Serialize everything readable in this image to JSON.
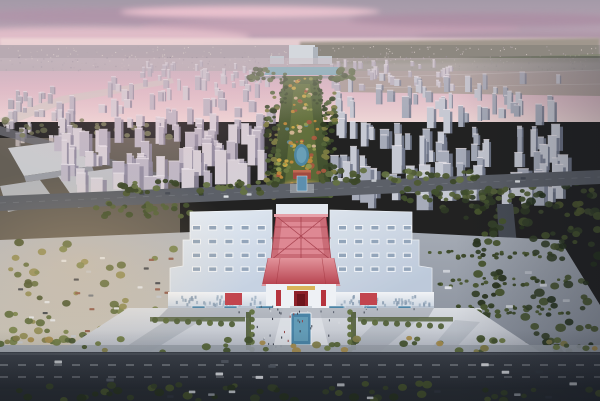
{
  "scene": {
    "description": "Dusk aerial rendering: symmetric exhibition hall with red steel gate tower, long landscaped park axis flanked by high-rise residential blocks, front plaza with reflecting pool, parking lots and city roads under a pink-violet sky"
  },
  "palette": {
    "sky_top": "#a49aa8",
    "sky_mid": "#c2a6b8",
    "sky_pink": "#e2b9c6",
    "sky_horizon": "#eed6d6",
    "haze_city": "#b7aab1",
    "park_mid": "#5a6a3c",
    "park_dark": "#3a482a",
    "lawn": "#71803f",
    "lake": "#79aebb",
    "pond": "#4e86a0",
    "pond_inner": "#6fa3bb",
    "roof_light": "#e9eff6",
    "roof_shadow": "#c6d2e2",
    "facade_light": "#f1f3f6",
    "facade_shadow": "#c9d3df",
    "hip_light": "#e2939b",
    "hip_dark": "#b53f4c",
    "lattice": "#d4717c",
    "lattice_line": "#a13a46",
    "red_accent": "#c2454e",
    "door_red": "#8e2129",
    "gold": "#d8b35a",
    "plaza_light": "#d9dce1",
    "plaza_dark": "#b6bbc5",
    "pool": "#4a84a6",
    "pool_inner": "#67a0ba",
    "kiosk": "#4f86a8",
    "road_light": "#3e434c",
    "road_dark": "#2a2f36",
    "back_road": "#5c6068",
    "hedge": "#4a5730",
    "end_tower": "#d4d8dd"
  },
  "kiosks": {
    "xs": [
      192,
      224,
      256,
      332,
      364,
      398
    ],
    "y": 306,
    "w": 13,
    "h": 6
  },
  "generators": [
    {
      "type": "specks",
      "target": "g-horizon-specks",
      "seed": 101,
      "count": 260,
      "region": [
        0,
        46,
        600,
        22
      ],
      "size": 1.1,
      "hr": 1,
      "colors": [
        "#d9cdc9",
        "#c7b9bb",
        "#b5a8ae",
        "#e3d6d0"
      ],
      "opacity": 0.7
    },
    {
      "type": "specks",
      "target": "g-horizon-specks",
      "seed": 102,
      "count": 150,
      "region": [
        0,
        56,
        600,
        14
      ],
      "size": 1.3,
      "hr": 1,
      "colors": [
        "#9e94a0",
        "#8d8492",
        "#ab9fa8"
      ],
      "opacity": 0.6
    },
    {
      "type": "towers",
      "target": "g-far-city",
      "seed": 103,
      "count": 40,
      "region": [
        140,
        66,
        130,
        26
      ],
      "w": [
        2.5,
        5
      ],
      "h": [
        5,
        12
      ],
      "scale": [
        0.7,
        1
      ],
      "faces": [
        "#cfc8d1",
        "#bab3c0",
        "#a29aab"
      ]
    },
    {
      "type": "towers",
      "target": "g-far-city",
      "seed": 104,
      "count": 38,
      "region": [
        330,
        66,
        120,
        26
      ],
      "w": [
        2.5,
        5
      ],
      "h": [
        5,
        12
      ],
      "scale": [
        0.7,
        1
      ],
      "faces": [
        "#cfc8d1",
        "#bab3c0",
        "#a29aab"
      ]
    },
    {
      "type": "towers",
      "target": "g-far-city",
      "seed": 105,
      "count": 26,
      "region": [
        0,
        92,
        62,
        55
      ],
      "w": [
        3,
        6
      ],
      "h": [
        6,
        14
      ],
      "scale": [
        0.7,
        1
      ],
      "faces": [
        "#c9c2c9",
        "#b3adb8",
        "#968fa0"
      ]
    },
    {
      "type": "blobs",
      "target": "g-left-district",
      "seed": 106,
      "count": 30,
      "region": [
        0,
        120,
        180,
        18
      ],
      "r": [
        2,
        4
      ],
      "colors": [
        "#6d6f52",
        "#7d7f5c",
        "#5d6146"
      ],
      "opacity": 0.85
    },
    {
      "type": "towers",
      "target": "g-city-left",
      "seed": 107,
      "count": 120,
      "region": [
        52,
        90,
        215,
        110
      ],
      "w": [
        4,
        9
      ],
      "h": [
        9,
        26
      ],
      "scale": [
        0.55,
        1.45
      ],
      "faces": [
        "#d6cfd6",
        "#beb7c4",
        "#8f8a9d"
      ]
    },
    {
      "type": "towers",
      "target": "g-city-right",
      "seed": 108,
      "count": 135,
      "region": [
        330,
        80,
        228,
        132
      ],
      "w": [
        4,
        9
      ],
      "h": [
        9,
        26
      ],
      "scale": [
        0.55,
        1.5
      ],
      "faces": [
        "#c6c9d3",
        "#a6abb9",
        "#737a8d"
      ]
    },
    {
      "type": "blobs",
      "target": "g-city-right",
      "seed": 109,
      "count": 55,
      "region": [
        430,
        182,
        170,
        36
      ],
      "r": [
        2.5,
        5
      ],
      "colors": [
        "#3f4a30",
        "#2f3a26",
        "#4c572f"
      ],
      "opacity": 0.9
    },
    {
      "type": "blobs",
      "target": "g-park-belts",
      "seed": 110,
      "count": 60,
      "region": [
        266,
        92,
        13,
        106
      ],
      "r": [
        1.6,
        3.4
      ],
      "colors": [
        "#3c4a2b",
        "#2f3b22",
        "#55663a",
        "#7c7c42"
      ],
      "opacity": 0.95
    },
    {
      "type": "blobs",
      "target": "g-park-belts",
      "seed": 111,
      "count": 60,
      "region": [
        323,
        92,
        13,
        106
      ],
      "r": [
        1.6,
        3.4
      ],
      "colors": [
        "#3c4a2b",
        "#2f3b22",
        "#55663a",
        "#7c7c42"
      ],
      "opacity": 0.95
    },
    {
      "type": "blobs",
      "target": "g-park-belts",
      "seed": 112,
      "count": 26,
      "region": [
        280,
        74,
        8,
        30
      ],
      "r": [
        1.2,
        2.4
      ],
      "colors": [
        "#3f4c2d",
        "#54663c"
      ],
      "opacity": 0.9
    },
    {
      "type": "blobs",
      "target": "g-park-belts",
      "seed": 113,
      "count": 26,
      "region": [
        314,
        74,
        8,
        30
      ],
      "r": [
        1.2,
        2.4
      ],
      "colors": [
        "#3f4c2d",
        "#54663c"
      ],
      "opacity": 0.9
    },
    {
      "type": "blobs",
      "target": "g-park-belts",
      "seed": 114,
      "count": 20,
      "region": [
        248,
        68,
        26,
        12
      ],
      "r": [
        2,
        4
      ],
      "colors": [
        "#465233",
        "#5a6a3e"
      ],
      "opacity": 0.9
    },
    {
      "type": "blobs",
      "target": "g-park-belts",
      "seed": 115,
      "count": 20,
      "region": [
        330,
        68,
        26,
        12
      ],
      "r": [
        2,
        4
      ],
      "colors": [
        "#465233",
        "#5a6a3e"
      ],
      "opacity": 0.9
    },
    {
      "type": "blobs",
      "target": "g-park-accents",
      "seed": 116,
      "count": 26,
      "region": [
        290,
        78,
        22,
        36
      ],
      "r": [
        1,
        2.4
      ],
      "colors": [
        "#c08a3c",
        "#ccaa48",
        "#a85a40",
        "#8f9a50",
        "#d3b693"
      ],
      "opacity": 0.95
    },
    {
      "type": "blobs",
      "target": "g-park-accents",
      "seed": 117,
      "count": 34,
      "region": [
        284,
        114,
        34,
        44
      ],
      "r": [
        1.2,
        2.8
      ],
      "colors": [
        "#c08a3c",
        "#ccaa48",
        "#a85a40",
        "#8f9a50",
        "#d3b693",
        "#5a8a96"
      ],
      "opacity": 0.95
    },
    {
      "type": "blobs",
      "target": "g-park-accents",
      "seed": 118,
      "count": 34,
      "region": [
        278,
        160,
        46,
        34
      ],
      "r": [
        1.4,
        3.2
      ],
      "colors": [
        "#c08a3c",
        "#ccaa48",
        "#a85a40",
        "#8f9a50",
        "#6b7a42"
      ],
      "opacity": 0.95
    },
    {
      "type": "cars",
      "target": "g-back-road",
      "seed": 119,
      "count": 5,
      "region": [
        80,
        191,
        170,
        6
      ],
      "w": 5,
      "h": 2.4,
      "colors": [
        "#e4e7ea",
        "#454a54",
        "#c6cad0"
      ]
    },
    {
      "type": "cars",
      "target": "g-back-road",
      "seed": 120,
      "count": 5,
      "region": [
        360,
        177,
        170,
        6
      ],
      "w": 5,
      "h": 2.4,
      "colors": [
        "#e4e7ea",
        "#454a54",
        "#c6cad0"
      ]
    },
    {
      "type": "blobs",
      "target": "g-back-road",
      "seed": 121,
      "count": 40,
      "region": [
        120,
        181,
        165,
        13
      ],
      "r": [
        2.2,
        4.2
      ],
      "colors": [
        "#4e5a33",
        "#3c4829",
        "#647243"
      ],
      "opacity": 0.95
    },
    {
      "type": "blobs",
      "target": "g-back-road",
      "seed": 122,
      "count": 40,
      "region": [
        318,
        170,
        160,
        13
      ],
      "r": [
        2.2,
        4.2
      ],
      "colors": [
        "#4e5a33",
        "#3c4829",
        "#647243"
      ],
      "opacity": 0.95
    },
    {
      "type": "blobs",
      "target": "g-back-road",
      "seed": 123,
      "count": 28,
      "region": [
        88,
        203,
        110,
        14
      ],
      "r": [
        2.2,
        4
      ],
      "colors": [
        "#55623a",
        "#41502d"
      ],
      "opacity": 0.95
    },
    {
      "type": "blobs",
      "target": "g-back-road",
      "seed": 124,
      "count": 30,
      "region": [
        400,
        188,
        130,
        14
      ],
      "r": [
        2.2,
        4
      ],
      "colors": [
        "#55623a",
        "#41502d"
      ],
      "opacity": 0.95
    },
    {
      "type": "blobs",
      "target": "g-right-trees",
      "seed": 125,
      "count": 70,
      "region": [
        475,
        205,
        28,
        190
      ],
      "r": [
        2.5,
        5
      ],
      "colors": [
        "#36422a",
        "#2a3520",
        "#48552e"
      ],
      "opacity": 0.95
    },
    {
      "type": "blobs",
      "target": "g-right-trees",
      "seed": 126,
      "count": 80,
      "region": [
        520,
        195,
        80,
        200
      ],
      "r": [
        2.5,
        5.5
      ],
      "colors": [
        "#333f28",
        "#27331f",
        "#45522d"
      ],
      "opacity": 0.9
    },
    {
      "type": "blobs",
      "target": "g-right-hedges",
      "seed": 127,
      "count": 24,
      "region": [
        428,
        250,
        125,
        8
      ],
      "r": [
        1.6,
        2.6
      ],
      "colors": [
        "#49562f",
        "#3a4727"
      ],
      "opacity": 0.95
    },
    {
      "type": "blobs",
      "target": "g-right-hedges",
      "seed": 128,
      "count": 24,
      "region": [
        438,
        278,
        130,
        8
      ],
      "r": [
        1.6,
        2.6
      ],
      "colors": [
        "#49562f",
        "#3a4727"
      ],
      "opacity": 0.95
    },
    {
      "type": "blobs",
      "target": "g-right-hedges",
      "seed": 129,
      "count": 24,
      "region": [
        448,
        306,
        135,
        8
      ],
      "r": [
        1.6,
        2.6
      ],
      "colors": [
        "#49562f",
        "#3a4727"
      ],
      "opacity": 0.95
    },
    {
      "type": "cars",
      "target": "g-right-buses",
      "seed": 130,
      "count": 9,
      "region": [
        434,
        258,
        140,
        70
      ],
      "w": 7,
      "h": 2.8,
      "colors": [
        "#e0e4e9",
        "#cdd2d8",
        "#b8bec6"
      ]
    },
    {
      "type": "blobs",
      "target": "g-left-lot-trees",
      "seed": 131,
      "count": 75,
      "region": [
        5,
        242,
        245,
        102
      ],
      "r": [
        2.5,
        5
      ],
      "colors": [
        "#5c6a3c",
        "#75814a",
        "#8d8a52",
        "#49552f"
      ],
      "opacity": 0.92
    },
    {
      "type": "cars",
      "target": "g-left-lot-cars",
      "seed": 132,
      "count": 48,
      "region": [
        8,
        252,
        230,
        92
      ],
      "w": 5,
      "h": 2.2,
      "colors": [
        "#e2e5e9",
        "#3d424b",
        "#c3c7cd",
        "#6f7580",
        "#8f5a4a"
      ]
    },
    {
      "type": "skylights",
      "target": "g-roof-lights",
      "x": 192,
      "y": 225,
      "cols": 5,
      "rows": 4,
      "cw": 9,
      "ch": 5.5,
      "gx": 16.2,
      "gy": 13.8,
      "frame": "#f1f4f8",
      "glass": "#93a5ba"
    },
    {
      "type": "skylights",
      "target": "g-roof-lights",
      "x": 338,
      "y": 225,
      "cols": 5,
      "rows": 4,
      "cw": 9,
      "ch": 5.5,
      "gx": 16.2,
      "gy": 13.8,
      "frame": "#f1f4f8",
      "glass": "#93a5ba"
    },
    {
      "type": "specks",
      "target": "g-facade-windows",
      "seed": 133,
      "count": 42,
      "region": [
        174,
        295,
        90,
        9
      ],
      "size": 2,
      "hr": 1.6,
      "colors": [
        "#9fb0c2",
        "#8a9cb0"
      ],
      "opacity": 0.85
    },
    {
      "type": "specks",
      "target": "g-facade-windows",
      "seed": 134,
      "count": 42,
      "region": [
        340,
        295,
        90,
        9
      ],
      "size": 2,
      "hr": 1.6,
      "colors": [
        "#9fb0c2",
        "#8a9cb0"
      ],
      "opacity": 0.85
    },
    {
      "type": "rows",
      "target": "g-plaza-trees",
      "x": 252,
      "y": 312,
      "dx": 0,
      "dy": 7.5,
      "count": 6,
      "r": 2.8,
      "colors": [
        "#55653a",
        "#61713f"
      ]
    },
    {
      "type": "rows",
      "target": "g-plaza-trees",
      "x": 350,
      "y": 312,
      "dx": 0,
      "dy": 7.5,
      "count": 6,
      "r": 2.8,
      "colors": [
        "#55653a",
        "#61713f"
      ]
    },
    {
      "type": "rows",
      "target": "g-plaza-trees",
      "x": 155,
      "y": 320,
      "dx": 11,
      "dy": 0.6,
      "count": 8,
      "r": 3,
      "colors": [
        "#5d6c3d",
        "#52613a"
      ]
    },
    {
      "type": "rows",
      "target": "g-plaza-trees",
      "x": 364,
      "y": 322,
      "dx": 11,
      "dy": 0.6,
      "count": 8,
      "r": 3,
      "colors": [
        "#5d6c3d",
        "#52613a"
      ]
    },
    {
      "type": "specks",
      "target": "g-plaza-people",
      "seed": 135,
      "count": 30,
      "region": [
        252,
        312,
        100,
        36
      ],
      "size": 1,
      "hr": 2.2,
      "colors": [
        "#2e3440",
        "#d8dce0",
        "#913f3f",
        "#4a5260"
      ],
      "opacity": 0.95
    },
    {
      "type": "specks",
      "target": "g-plaza-people",
      "seed": 136,
      "count": 16,
      "region": [
        185,
        305,
        230,
        7
      ],
      "size": 1,
      "hr": 2,
      "colors": [
        "#2e3440",
        "#d8dce0",
        "#4a5260"
      ],
      "opacity": 0.9
    },
    {
      "type": "blobs",
      "target": "g-front-trees",
      "seed": 137,
      "count": 55,
      "region": [
        0,
        338,
        600,
        14
      ],
      "r": [
        2.6,
        4.6
      ],
      "colors": [
        "#57663a",
        "#6d7a44",
        "#465430",
        "#837e4c",
        "#a38b4e"
      ],
      "opacity": 0.95
    },
    {
      "type": "cars",
      "target": "g-front-cars",
      "seed": 138,
      "count": 11,
      "region": [
        30,
        357,
        540,
        27
      ],
      "w": 7.5,
      "h": 3,
      "colors": [
        "#e8eaee",
        "#363b44",
        "#c9cdd2",
        "#555c66"
      ]
    },
    {
      "type": "blobs",
      "target": "g-bottom",
      "seed": 139,
      "count": 55,
      "region": [
        0,
        383,
        600,
        18
      ],
      "r": [
        2.8,
        5.2
      ],
      "colors": [
        "#39462b",
        "#2b3722",
        "#4a572f"
      ],
      "opacity": 0.95
    },
    {
      "type": "cars",
      "target": "g-bottom",
      "seed": 140,
      "count": 8,
      "region": [
        130,
        389,
        440,
        9
      ],
      "w": 6.5,
      "h": 2.6,
      "colors": [
        "#d9dde2",
        "#343942",
        "#9aa0a8"
      ]
    }
  ]
}
